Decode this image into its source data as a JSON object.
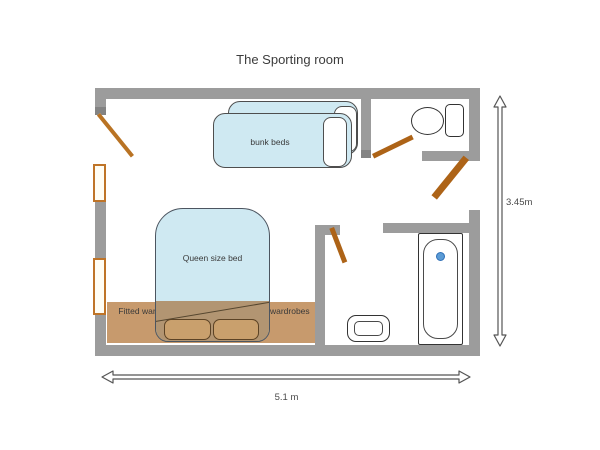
{
  "title": "The Sporting room",
  "labels": {
    "bunk_beds": "bunk beds",
    "queen_bed": "Queen size bed",
    "wardrobe_left": "Fitted wardrobes",
    "wardrobe_right": "Fitted wardrobes"
  },
  "dimensions": {
    "width": "5.1 m",
    "height": "3.45m"
  },
  "colors": {
    "wall_gray": "#9c9c9c",
    "bed_fill": "#cfe9f2",
    "bed_border": "#4e4e4e",
    "wardrobe_fill": "#c79a6d",
    "door_leaf_orange": "#ad6317",
    "window_border_orange": "#bf7428",
    "bath_drain_blue": "#5b9bd5",
    "dimension_line": "#555555",
    "text": "#3a3a3a"
  }
}
